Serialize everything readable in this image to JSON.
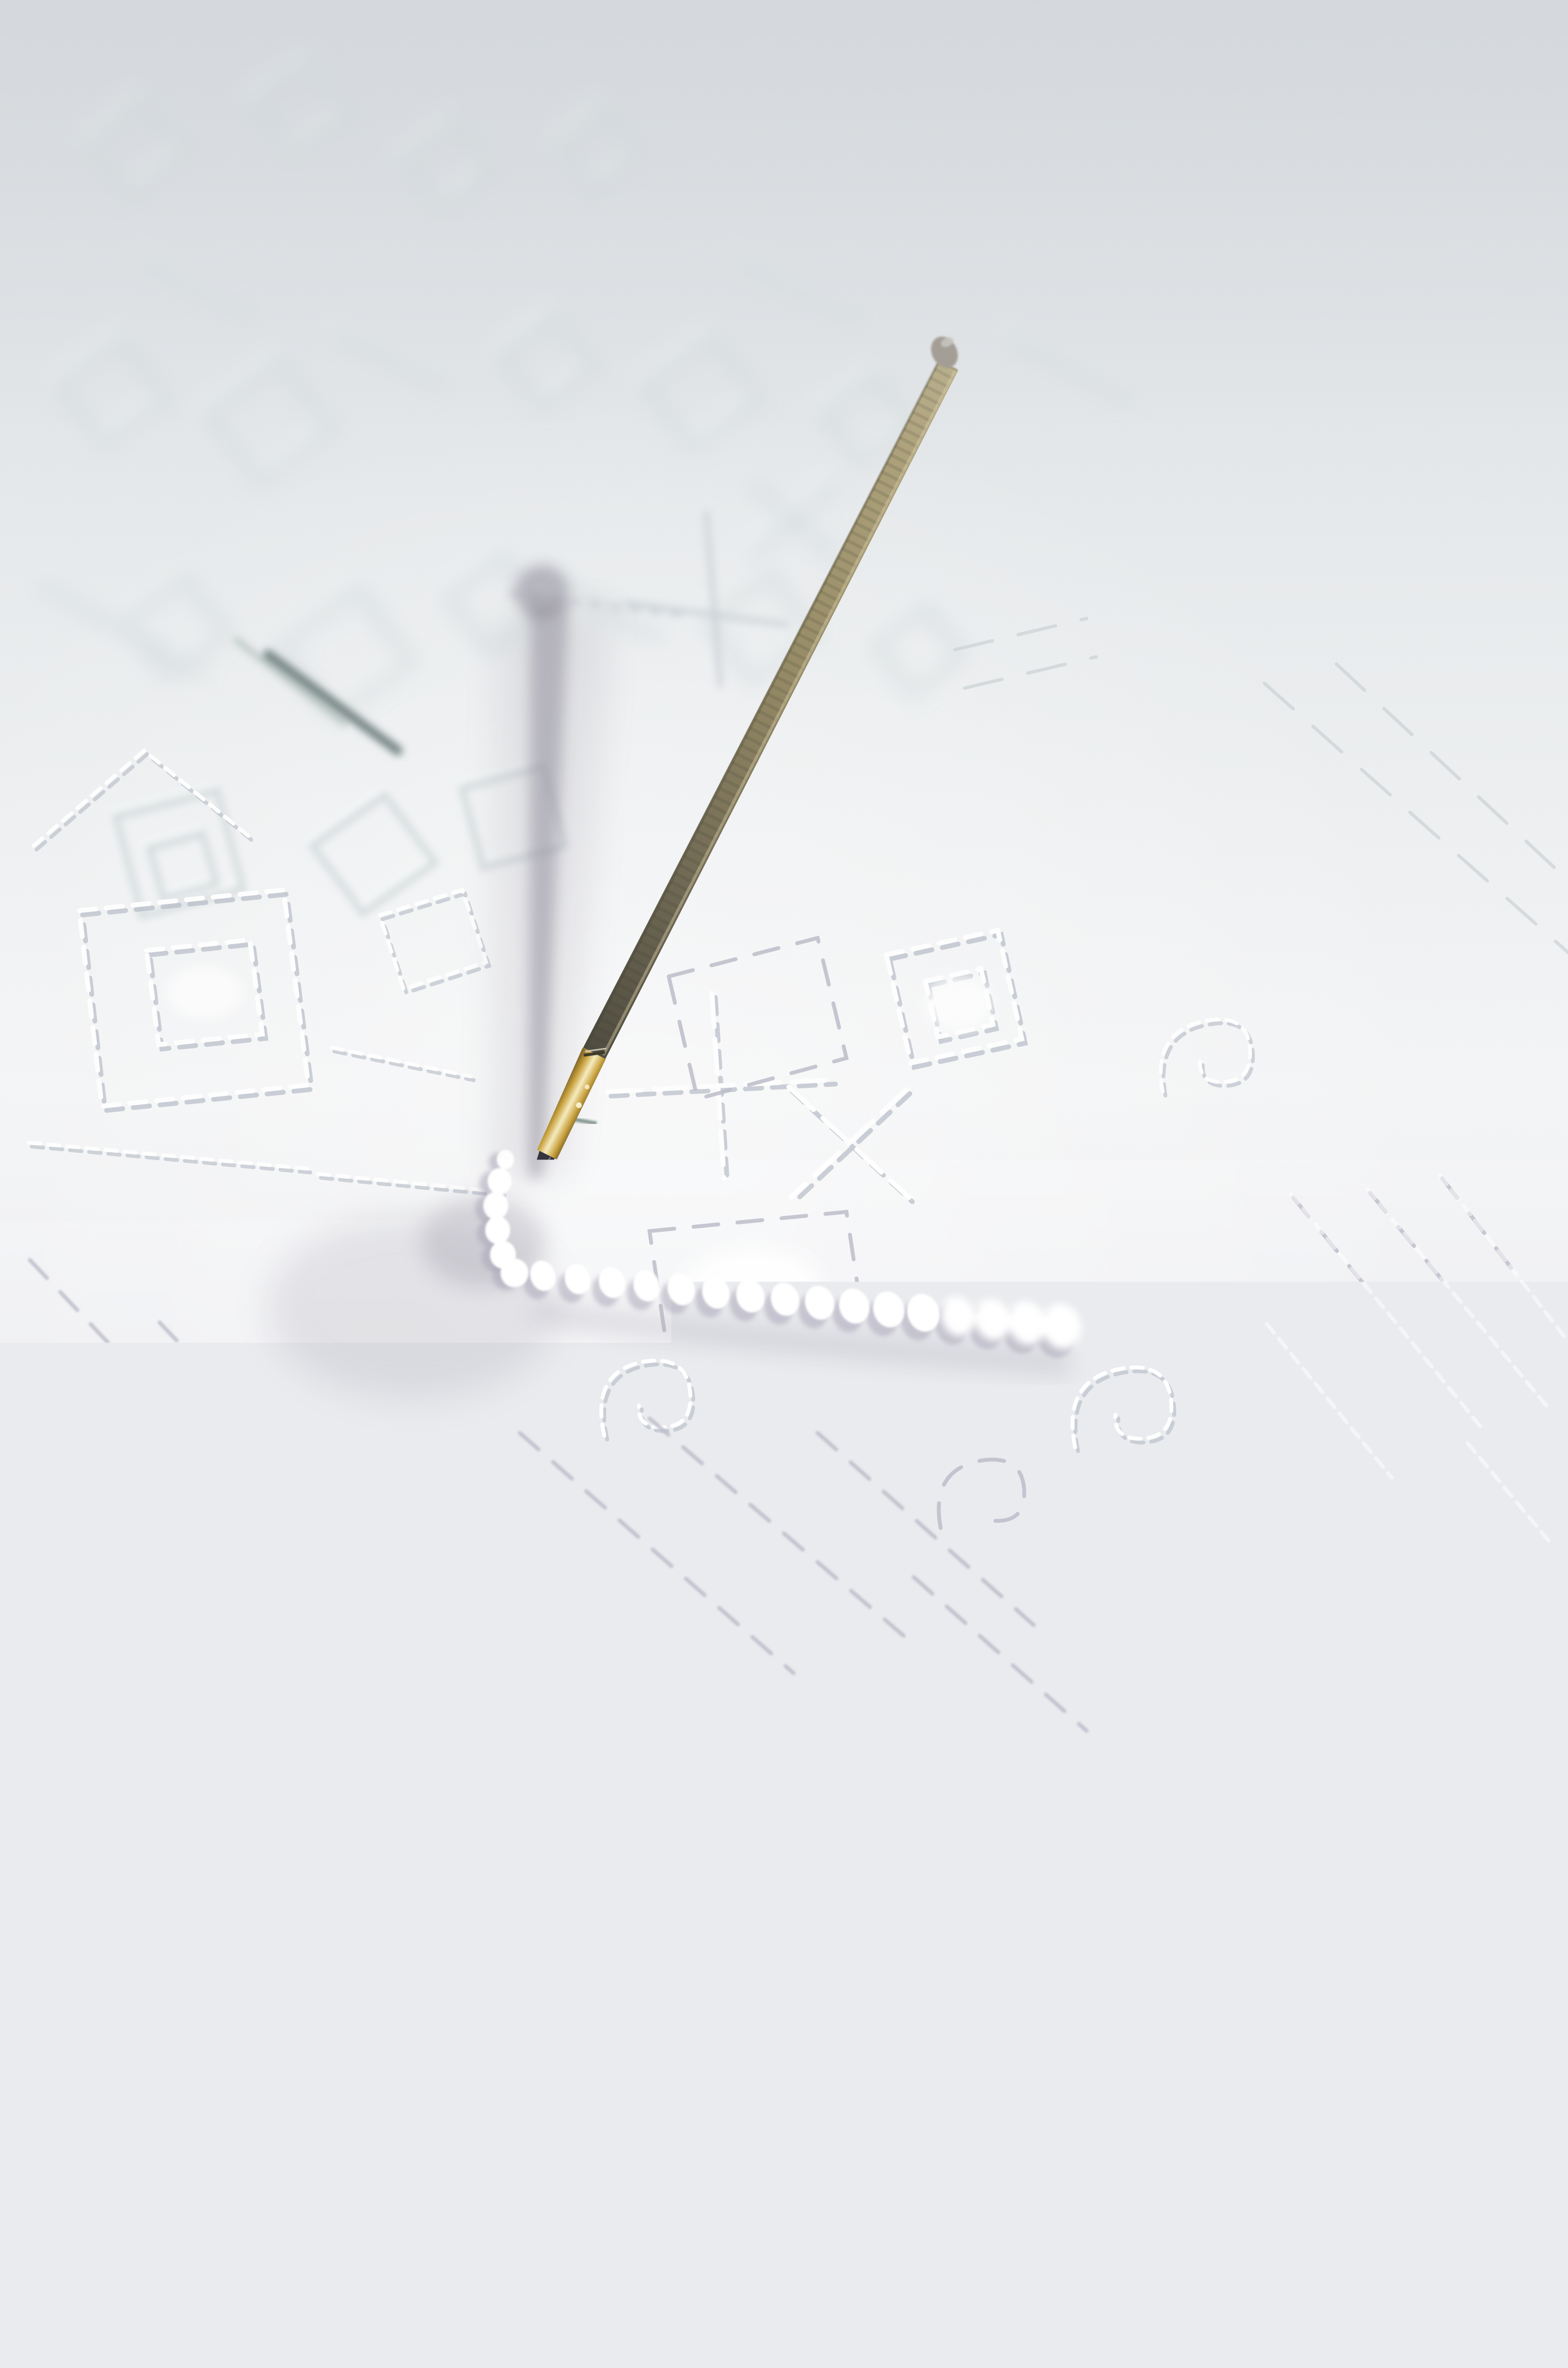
{
  "image": {
    "type": "photograph",
    "orientation": "portrait",
    "description": "Macro photograph of white-on-white embroidery: a thread-wrapped needle tool stands upright, its dark steel tip and brass ferrule piercing white fabric at the corner of an angled white coiled cord; the cloth is covered with embossed folk motifs (nested squares, diamonds, crosses, spirals, dashed running stitches), out of focus toward the top and bottom.",
    "visible_text": ""
  },
  "scene": {
    "surface": "white fabric embroidered with white thread geometric motifs: nested squares, diamonds, plus and X crosses, spirals, long dashed diagonal running-stitch lines",
    "lighting": "soft daylight from the upper right; bright sharp-focus band across the middle, soft blur at top and bottom",
    "objects": [
      {
        "name": "stylus-needle",
        "description": "upright needle tool leaning left, pierced into the fabric",
        "parts": [
          "blunt wrapped head",
          "cord-wrapped tapering shaft (tan fading to dark olive)",
          "shiny brass ferrule",
          "dark steel tip"
        ]
      },
      {
        "name": "chenille-cord",
        "description": "white coiled cord couched onto the fabric forming a right-angle: short arm up from the needle tip, long arm running right and slightly down"
      },
      {
        "name": "needle-shadow",
        "description": "soft diagonal gray shadow of the tool cast up and left, with rounded head"
      },
      {
        "name": "loose-needle",
        "description": "small dark slate needle lying on the cloth at mid left, out of focus"
      },
      {
        "name": "embossed-motifs",
        "description": "white stitched nested squares, diamonds, crosses, spirals and dashed diagonal lines, blurred in the distance"
      }
    ]
  },
  "palette": {
    "paper_top": "#d8dce0",
    "paper_upper": "#e8ebed",
    "paper_bright": "#f5f6f7",
    "paper_lower": "#e9e9ee",
    "paper_bottom": "#d6d7de",
    "emboss_blur_line": "#b4c1c4",
    "emboss_blur_highlight": "#f8fbfb",
    "thread_white": "#ffffff",
    "thread_shadow": "#b7bcc8",
    "thread_gray": "#bdbdca",
    "faint_line": "#ccd3d6",
    "shaft_top": "#b7ab83",
    "shaft_mid": "#958a64",
    "shaft_low": "#6b6450",
    "shaft_dark": "#4e4b3e",
    "head_gray": "#9d968c",
    "head_shine": "#c9c5bf",
    "brass_dark": "#7a5e20",
    "brass_mid": "#caa33c",
    "brass_light": "#f7ecc0",
    "tip_dark": "#30303a",
    "shadow_gray": "#8e8b99",
    "coil_white": "#ffffff",
    "coil_shadow": "#a59fb3",
    "loose_needle": "#5f7270",
    "green_stitch": "#3e5a4e"
  }
}
